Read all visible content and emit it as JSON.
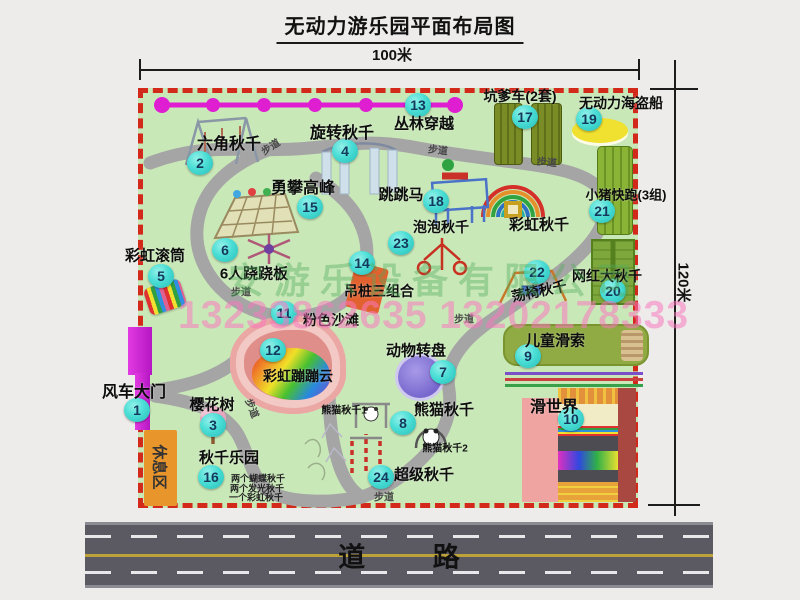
{
  "title": "无动力游乐园平面布局图",
  "dimensions": {
    "width": "100米",
    "height": "120米"
  },
  "watermark": {
    "company": "安游乐设备有限公司",
    "phone": "13233862635 13202178333"
  },
  "road": {
    "label": "道 路"
  },
  "rest_area": {
    "label": "休息区"
  },
  "colors": {
    "map_green": "#c9e8b8",
    "border_red": "#d2291b",
    "path_gray": "#a5a5a5",
    "badge_teal": "#49ddd5",
    "zipline_magenta": "#de1ed0",
    "gate_magenta": "#cc2ad4",
    "rest_orange": "#e8952c",
    "road_gray": "#5b5a62",
    "beach_pink": "#e08e8a"
  },
  "attractions": [
    {
      "id": "1",
      "name": "风车大门",
      "badge": [
        137,
        410
      ],
      "label": [
        134,
        390
      ],
      "size": 16
    },
    {
      "id": "2",
      "name": "六角秋千",
      "badge": [
        200,
        163
      ],
      "label": [
        229,
        142
      ],
      "size": 16
    },
    {
      "id": "3",
      "name": "樱花树",
      "badge": [
        213,
        425
      ],
      "label": [
        212,
        404
      ],
      "size": 15
    },
    {
      "id": "4",
      "name": "旋转秋千",
      "badge": [
        345,
        151
      ],
      "label": [
        342,
        131
      ],
      "size": 16
    },
    {
      "id": "5",
      "name": "彩虹滚筒",
      "badge": [
        161,
        276
      ],
      "label": [
        155,
        255
      ],
      "size": 15
    },
    {
      "id": "6",
      "name": "6人跷跷板",
      "badge": [
        225,
        250
      ],
      "label": [
        254,
        273
      ],
      "size": 15
    },
    {
      "id": "7",
      "name": "动物转盘",
      "badge": [
        443,
        372
      ],
      "label": [
        416,
        350
      ],
      "size": 15
    },
    {
      "id": "8",
      "name": "熊猫秋千",
      "badge": [
        403,
        423
      ],
      "label": [
        444,
        409
      ],
      "size": 15
    },
    {
      "id": "9",
      "name": "儿童滑索",
      "badge": [
        528,
        356
      ],
      "label": [
        555,
        340
      ],
      "size": 15
    },
    {
      "id": "10",
      "name": "滑世界",
      "badge": [
        571,
        419
      ],
      "label": [
        554,
        405
      ],
      "size": 16
    },
    {
      "id": "11",
      "name": "粉色沙滩",
      "badge": [
        284,
        313
      ],
      "label": [
        331,
        320
      ],
      "size": 14
    },
    {
      "id": "12",
      "name": "彩虹蹦蹦云",
      "badge": [
        273,
        350
      ],
      "label": [
        298,
        376
      ],
      "size": 14
    },
    {
      "id": "13",
      "name": "丛林穿越",
      "badge": [
        418,
        105
      ],
      "label": [
        424,
        123
      ],
      "size": 15
    },
    {
      "id": "14",
      "name": "吊桩三组合",
      "badge": [
        362,
        263
      ],
      "label": [
        379,
        291
      ],
      "size": 14
    },
    {
      "id": "15",
      "name": "勇攀高峰",
      "badge": [
        310,
        207
      ],
      "label": [
        303,
        186
      ],
      "size": 16
    },
    {
      "id": "16",
      "name": "秋千乐园",
      "badge": [
        211,
        477
      ],
      "label": [
        229,
        457
      ],
      "size": 15
    },
    {
      "id": "17",
      "name": "坑爹车(2套)",
      "badge": [
        525,
        117
      ],
      "label": [
        520,
        96
      ],
      "size": 14
    },
    {
      "id": "18",
      "name": "跳跳马",
      "badge": [
        436,
        201
      ],
      "label": [
        401,
        194
      ],
      "size": 15
    },
    {
      "id": "19",
      "name": "无动力海盗船",
      "badge": [
        589,
        119
      ],
      "label": [
        621,
        103
      ],
      "size": 14
    },
    {
      "id": "20",
      "name": "网红大秋千",
      "badge": [
        613,
        291
      ],
      "label": [
        607,
        276
      ],
      "size": 14
    },
    {
      "id": "21",
      "name": "小猪快跑(3组)",
      "badge": [
        602,
        211
      ],
      "label": [
        626,
        194
      ],
      "size": 13
    },
    {
      "id": "22",
      "name": "荡椅秋千",
      "badge": [
        537,
        272
      ],
      "label": [
        539,
        291
      ],
      "size": 14,
      "rot": -12
    },
    {
      "id": "23",
      "name": "泡泡秋千",
      "badge": [
        401,
        243
      ],
      "label": [
        441,
        227
      ],
      "size": 14
    },
    {
      "id": "24",
      "name": "超级秋千",
      "badge": [
        381,
        477
      ],
      "label": [
        424,
        474
      ],
      "size": 15
    },
    {
      "id": "",
      "name": "彩虹秋千",
      "badge": null,
      "label": [
        539,
        224
      ],
      "size": 15
    }
  ],
  "small_labels": [
    {
      "text": "步道",
      "x": 270,
      "y": 146,
      "rot": -33,
      "size": 10,
      "color": "#474747"
    },
    {
      "text": "步道",
      "x": 438,
      "y": 149,
      "rot": 6,
      "size": 10,
      "color": "#474747"
    },
    {
      "text": "步道",
      "x": 547,
      "y": 161,
      "rot": 5,
      "size": 10,
      "color": "#474747"
    },
    {
      "text": "步道",
      "x": 241,
      "y": 291,
      "rot": 0,
      "size": 10,
      "color": "#474747"
    },
    {
      "text": "步道",
      "x": 464,
      "y": 318,
      "rot": 0,
      "size": 10,
      "color": "#474747"
    },
    {
      "text": "步道",
      "x": 384,
      "y": 496,
      "rot": 0,
      "size": 10,
      "color": "#474747"
    },
    {
      "text": "步道",
      "x": 253,
      "y": 408,
      "rot": 68,
      "size": 10,
      "color": "#474747"
    },
    {
      "text": "熊猫秋千1",
      "x": 344,
      "y": 409,
      "rot": 0,
      "size": 10,
      "color": "#111111"
    },
    {
      "text": "熊猫秋千2",
      "x": 445,
      "y": 447,
      "rot": 0,
      "size": 10,
      "color": "#111111"
    },
    {
      "text": "两个蝴蝶秋千",
      "x": 258,
      "y": 478,
      "rot": 0,
      "size": 9,
      "color": "#222222"
    },
    {
      "text": "两个发光秋千",
      "x": 257,
      "y": 488,
      "rot": 0,
      "size": 9,
      "color": "#222222"
    },
    {
      "text": "一个彩虹秋千",
      "x": 256,
      "y": 497,
      "rot": 0,
      "size": 9,
      "color": "#222222"
    }
  ]
}
